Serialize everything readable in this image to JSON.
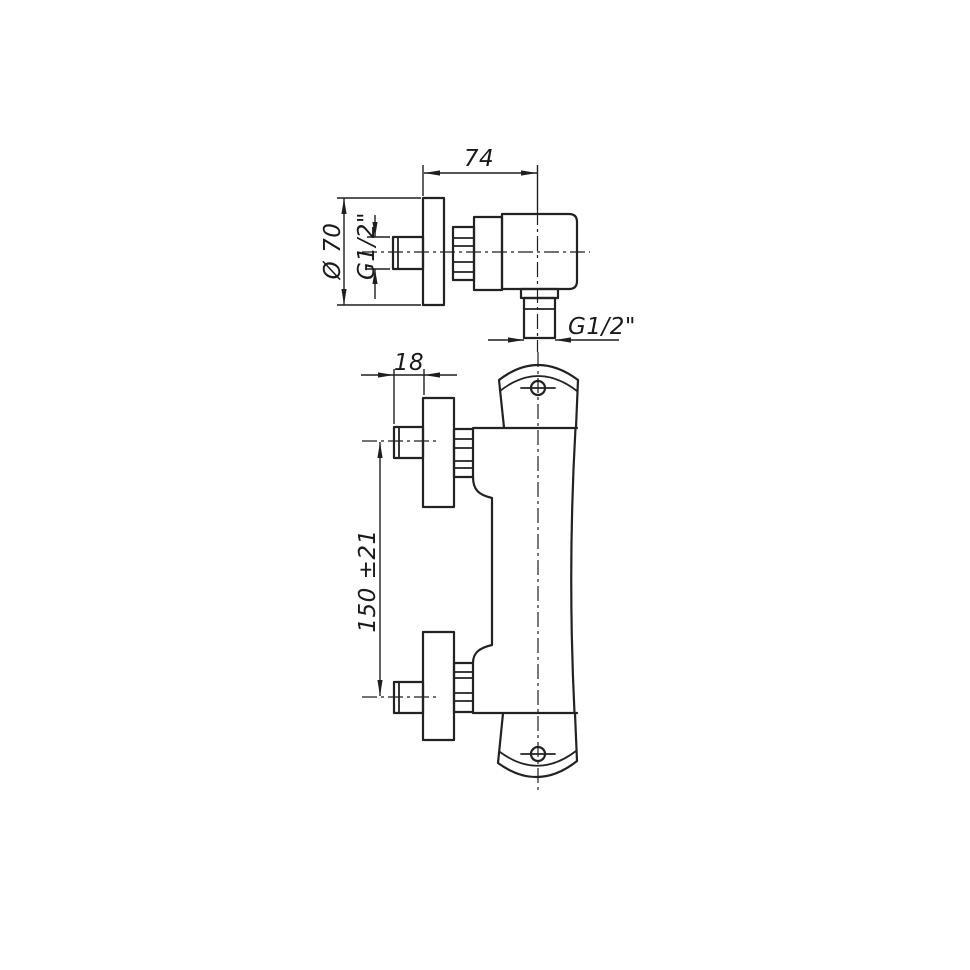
{
  "drawing": {
    "background_color": "#ffffff",
    "line_color": "#222222",
    "labels": {
      "top_width": "74",
      "flange_diameter": "Ø 70",
      "inlet_thread": "G1/2\"",
      "union_depth": "18",
      "center_distance": "150 ±21",
      "outlet_thread": "G1/2\""
    }
  }
}
